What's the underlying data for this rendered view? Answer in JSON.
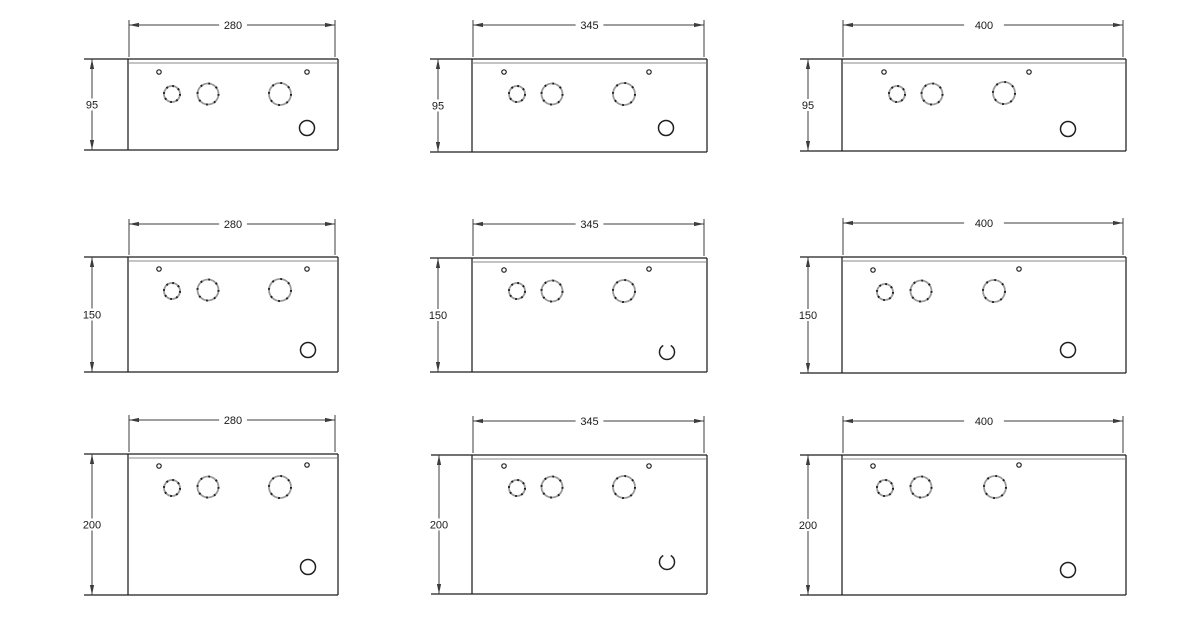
{
  "drawing": {
    "colors": {
      "background": "#ffffff",
      "box_line": "#1f1f1f",
      "dim_line": "#3c3c3c",
      "lip_line": "#8a8a8a",
      "knockout_ring": "#9a9a9a",
      "knockout_tick": "#1f1f1f",
      "text": "#1a1a1a"
    },
    "panels": [
      {
        "id": "enclosure-280x95",
        "width_label": "280",
        "height_label": "95",
        "box": {
          "left": 128,
          "top": 59,
          "right": 338,
          "bottom": 150
        },
        "lip_offset": 4,
        "width_dim_y": 25,
        "height_dim_x": 92,
        "label_mask_pad": 4,
        "screw_holes": [
          {
            "x": 159,
            "y": 72
          },
          {
            "x": 307,
            "y": 72
          }
        ],
        "knockouts": [
          {
            "x": 172,
            "y": 94,
            "r": 8
          },
          {
            "x": 208,
            "y": 94,
            "r": 10.5
          },
          {
            "x": 280,
            "y": 94,
            "r": 11
          }
        ],
        "aux_hole": {
          "x": 307,
          "y": 128,
          "r": 7.5,
          "gap_top": false
        }
      },
      {
        "id": "enclosure-345x95",
        "width_label": "345",
        "height_label": "95",
        "box": {
          "left": 472,
          "top": 59,
          "right": 707,
          "bottom": 152
        },
        "lip_offset": 4,
        "width_dim_y": 25,
        "height_dim_x": 438,
        "label_mask_pad": 4,
        "screw_holes": [
          {
            "x": 504,
            "y": 72
          },
          {
            "x": 649,
            "y": 72
          }
        ],
        "knockouts": [
          {
            "x": 517,
            "y": 94,
            "r": 8
          },
          {
            "x": 552,
            "y": 94,
            "r": 10.5
          },
          {
            "x": 624,
            "y": 94,
            "r": 11
          }
        ],
        "aux_hole": {
          "x": 666,
          "y": 128,
          "r": 7.5,
          "gap_top": false
        }
      },
      {
        "id": "enclosure-400x95",
        "width_label": "400",
        "height_label": "95",
        "box": {
          "left": 842,
          "top": 59,
          "right": 1126,
          "bottom": 151
        },
        "lip_offset": 4,
        "width_dim_y": 25,
        "height_dim_x": 808,
        "label_mask_pad": 10,
        "screw_holes": [
          {
            "x": 884,
            "y": 72
          },
          {
            "x": 1029,
            "y": 72
          }
        ],
        "knockouts": [
          {
            "x": 897,
            "y": 94,
            "r": 8
          },
          {
            "x": 932,
            "y": 94,
            "r": 10.5
          },
          {
            "x": 1004,
            "y": 93,
            "r": 11
          }
        ],
        "aux_hole": {
          "x": 1068,
          "y": 129,
          "r": 7.5,
          "gap_top": false
        }
      },
      {
        "id": "enclosure-280x150",
        "width_label": "280",
        "height_label": "150",
        "box": {
          "left": 128,
          "top": 257,
          "right": 338,
          "bottom": 372
        },
        "lip_offset": 4,
        "width_dim_y": 224,
        "height_dim_x": 92,
        "label_mask_pad": 4,
        "screw_holes": [
          {
            "x": 159,
            "y": 269
          },
          {
            "x": 307,
            "y": 269
          }
        ],
        "knockouts": [
          {
            "x": 172,
            "y": 291,
            "r": 8
          },
          {
            "x": 208,
            "y": 290,
            "r": 10.5
          },
          {
            "x": 280,
            "y": 290,
            "r": 11
          }
        ],
        "aux_hole": {
          "x": 308,
          "y": 350,
          "r": 7.5,
          "gap_top": false
        }
      },
      {
        "id": "enclosure-345x150",
        "width_label": "345",
        "height_label": "150",
        "box": {
          "left": 472,
          "top": 258,
          "right": 707,
          "bottom": 372
        },
        "lip_offset": 4,
        "width_dim_y": 224,
        "height_dim_x": 438,
        "label_mask_pad": 4,
        "screw_holes": [
          {
            "x": 504,
            "y": 270
          },
          {
            "x": 649,
            "y": 269
          }
        ],
        "knockouts": [
          {
            "x": 517,
            "y": 291,
            "r": 8
          },
          {
            "x": 552,
            "y": 291,
            "r": 10.5
          },
          {
            "x": 624,
            "y": 291,
            "r": 11
          }
        ],
        "aux_hole": {
          "x": 667,
          "y": 352,
          "r": 7.5,
          "gap_top": true
        }
      },
      {
        "id": "enclosure-400x150",
        "width_label": "400",
        "height_label": "150",
        "box": {
          "left": 842,
          "top": 257,
          "right": 1126,
          "bottom": 373
        },
        "lip_offset": 4,
        "width_dim_y": 223,
        "height_dim_x": 808,
        "label_mask_pad": 10,
        "screw_holes": [
          {
            "x": 873,
            "y": 270
          },
          {
            "x": 1019,
            "y": 269
          }
        ],
        "knockouts": [
          {
            "x": 885,
            "y": 292,
            "r": 8
          },
          {
            "x": 921,
            "y": 291,
            "r": 10.5
          },
          {
            "x": 994,
            "y": 291,
            "r": 11
          }
        ],
        "aux_hole": {
          "x": 1068,
          "y": 350,
          "r": 7.5,
          "gap_top": false
        }
      },
      {
        "id": "enclosure-280x200",
        "width_label": "280",
        "height_label": "200",
        "box": {
          "left": 128,
          "top": 454,
          "right": 338,
          "bottom": 595
        },
        "lip_offset": 4,
        "width_dim_y": 420,
        "height_dim_x": 92,
        "label_mask_pad": 4,
        "screw_holes": [
          {
            "x": 159,
            "y": 466
          },
          {
            "x": 307,
            "y": 465
          }
        ],
        "knockouts": [
          {
            "x": 172,
            "y": 488,
            "r": 8
          },
          {
            "x": 208,
            "y": 487,
            "r": 10.5
          },
          {
            "x": 280,
            "y": 487,
            "r": 11
          }
        ],
        "aux_hole": {
          "x": 308,
          "y": 567,
          "r": 7.5,
          "gap_top": false
        }
      },
      {
        "id": "enclosure-345x200",
        "width_label": "345",
        "height_label": "200",
        "box": {
          "left": 472,
          "top": 455,
          "right": 707,
          "bottom": 594
        },
        "lip_offset": 4,
        "width_dim_y": 421,
        "height_dim_x": 439,
        "label_mask_pad": 4,
        "screw_holes": [
          {
            "x": 504,
            "y": 466
          },
          {
            "x": 649,
            "y": 466
          }
        ],
        "knockouts": [
          {
            "x": 517,
            "y": 488,
            "r": 8
          },
          {
            "x": 552,
            "y": 487,
            "r": 10.5
          },
          {
            "x": 624,
            "y": 487,
            "r": 11
          }
        ],
        "aux_hole": {
          "x": 667,
          "y": 562,
          "r": 7.5,
          "gap_top": true
        }
      },
      {
        "id": "enclosure-400x200",
        "width_label": "400",
        "height_label": "200",
        "box": {
          "left": 842,
          "top": 455,
          "right": 1126,
          "bottom": 595
        },
        "lip_offset": 4,
        "width_dim_y": 421,
        "height_dim_x": 808,
        "label_mask_pad": 10,
        "screw_holes": [
          {
            "x": 873,
            "y": 466
          },
          {
            "x": 1019,
            "y": 465
          }
        ],
        "knockouts": [
          {
            "x": 885,
            "y": 488,
            "r": 8
          },
          {
            "x": 921,
            "y": 487,
            "r": 10.5
          },
          {
            "x": 995,
            "y": 487,
            "r": 11
          }
        ],
        "aux_hole": {
          "x": 1068,
          "y": 570,
          "r": 7.5,
          "gap_top": false
        }
      }
    ]
  }
}
